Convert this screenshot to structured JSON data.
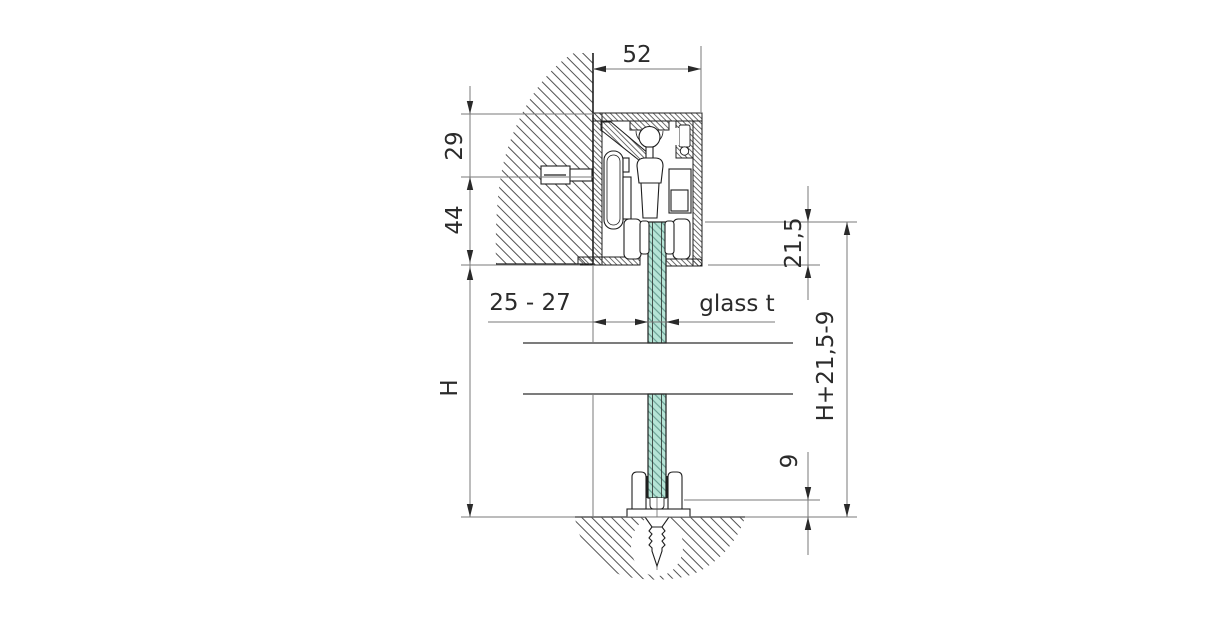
{
  "drawing": {
    "kind": "technical-section",
    "dimensions": {
      "track_width": "52",
      "top_offset": "29",
      "track_height": "44",
      "wall_clearance": "25 - 27",
      "glass_thickness": "glass t",
      "opening_height": "H",
      "glass_top_inset": "21,5",
      "glass_height_formula": "H+21,5-9",
      "floor_gap": "9"
    },
    "colors": {
      "line": "#1f1f1f",
      "dimension_line": "#7a7a7a",
      "glass_fill": "#b5e4d6",
      "glass_hatch": "#5d9488",
      "hatch": "#3f3f3f",
      "background": "#ffffff"
    }
  }
}
